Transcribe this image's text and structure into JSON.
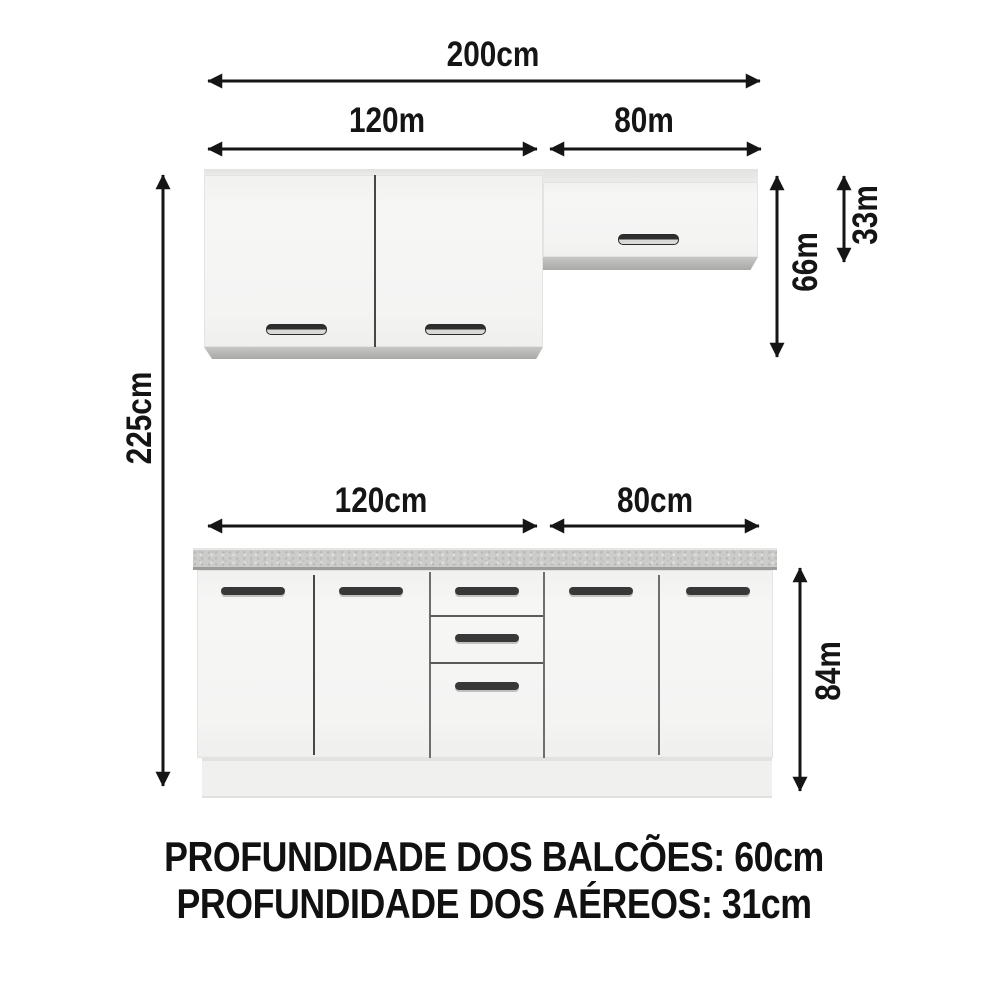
{
  "page": {
    "background": "#ffffff",
    "ink": "#151515"
  },
  "labels": {
    "total_width": "200cm",
    "aereo_left_width": "120m",
    "aereo_right_width": "80m",
    "total_height": "225cm",
    "aereo_left_height": "66m",
    "aereo_right_height": "33m",
    "balcao_left_width": "120cm",
    "balcao_right_width": "80cm",
    "balcao_height": "84m"
  },
  "notes": {
    "balcao_depth": "PROFUNDIDADE DOS BALCÕES: 60cm",
    "aereo_depth": "PROFUNDIDADE DOS AÉREOS: 31cm"
  },
  "colors": {
    "cabinet_face": "#f4f4f3",
    "cabinet_bottom_strip": "#b0b0ae",
    "countertop": "#cccccb",
    "handle": "#333333",
    "dimension_ink": "#151515"
  }
}
